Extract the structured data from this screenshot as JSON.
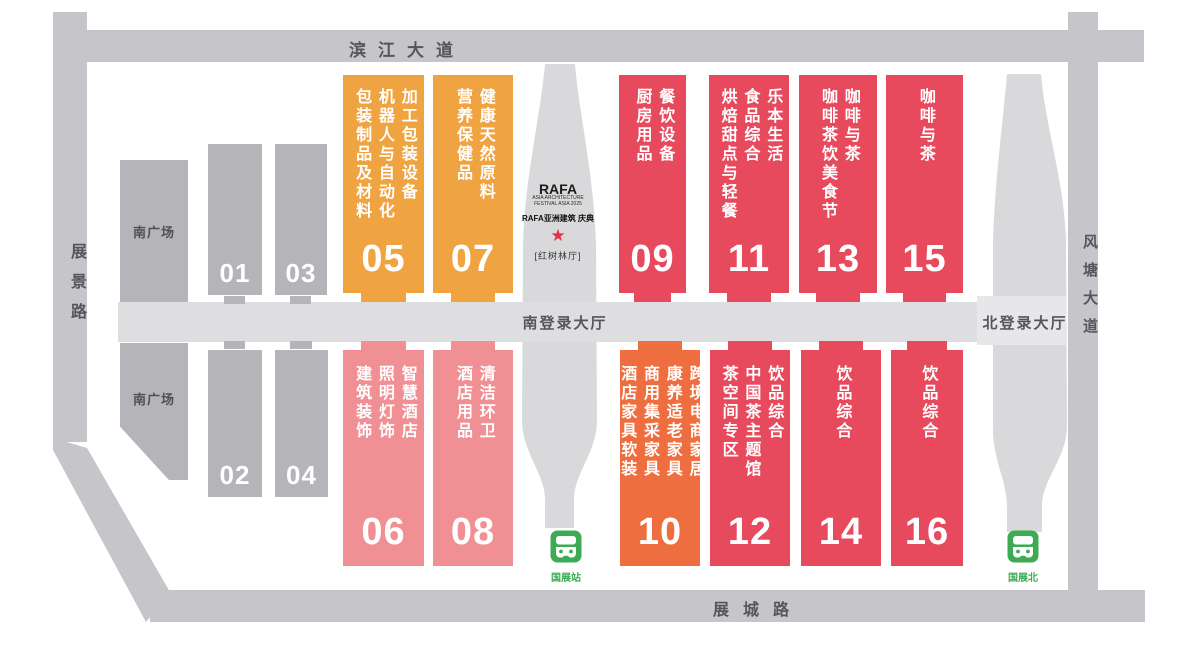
{
  "roads": {
    "top": "滨江大道",
    "left": "展景路",
    "right": "风塘大道",
    "bottom": "展城路"
  },
  "plazas": {
    "south_upper": "南广场",
    "south_lower": "南广场"
  },
  "lobbies": {
    "south": "南登录大厅",
    "north": "北登录大厅"
  },
  "rafa": {
    "title": "RAFA",
    "subtitle_line1": "ASIA ARCHITECTURE",
    "subtitle_line2": "FESTIVAL ASIA 2025",
    "cn_line": "RAFA亚洲建筑 庆典",
    "star": "★",
    "venue": "[红树林厅]"
  },
  "stations": {
    "south": {
      "label": "国展站"
    },
    "north": {
      "label": "国展北"
    }
  },
  "halls": {
    "h01": {
      "number": "01",
      "lines": []
    },
    "h02": {
      "number": "02",
      "lines": []
    },
    "h03": {
      "number": "03",
      "lines": []
    },
    "h04": {
      "number": "04",
      "lines": []
    },
    "h05": {
      "number": "05",
      "lines": [
        "加工包装设备",
        "机器人与自动化",
        "包装制品及材料"
      ]
    },
    "h06": {
      "number": "06",
      "lines": [
        "智慧酒店",
        "照明灯饰",
        "建筑装饰"
      ]
    },
    "h07": {
      "number": "07",
      "lines": [
        "健康天然原料",
        "营养保健品"
      ]
    },
    "h08": {
      "number": "08",
      "lines": [
        "清洁环卫",
        "酒店用品"
      ]
    },
    "h09": {
      "number": "09",
      "lines": [
        "餐饮设备",
        "厨房用品"
      ]
    },
    "h10": {
      "number": "10",
      "lines": [
        "跨境电商家居",
        "康养适老家具",
        "商用集采家具",
        "酒店家具软装"
      ]
    },
    "h11": {
      "number": "11",
      "lines": [
        "乐本生活",
        "食品综合",
        "烘焙甜点与轻餐"
      ]
    },
    "h12": {
      "number": "12",
      "lines": [
        "饮品综合",
        "中国茶主题馆",
        "茶空间专区"
      ]
    },
    "h13": {
      "number": "13",
      "lines": [
        "咖啡与茶",
        "咖啡茶饮美食节"
      ]
    },
    "h14": {
      "number": "14",
      "lines": [
        "饮品综合"
      ]
    },
    "h15": {
      "number": "15",
      "lines": [
        "咖啡与茶"
      ]
    },
    "h16": {
      "number": "16",
      "lines": [
        "饮品综合"
      ]
    }
  },
  "colors": {
    "red": "#e7495d",
    "orange": "#f0a441",
    "pink": "#f09094",
    "orange_red": "#ee6e3f",
    "gray_hall": "#b5b5b9",
    "road": "#c6c6ca",
    "band": "#dedee0",
    "tower": "#d9d9db",
    "green": "#3cab53",
    "star_red": "#e5304a"
  }
}
